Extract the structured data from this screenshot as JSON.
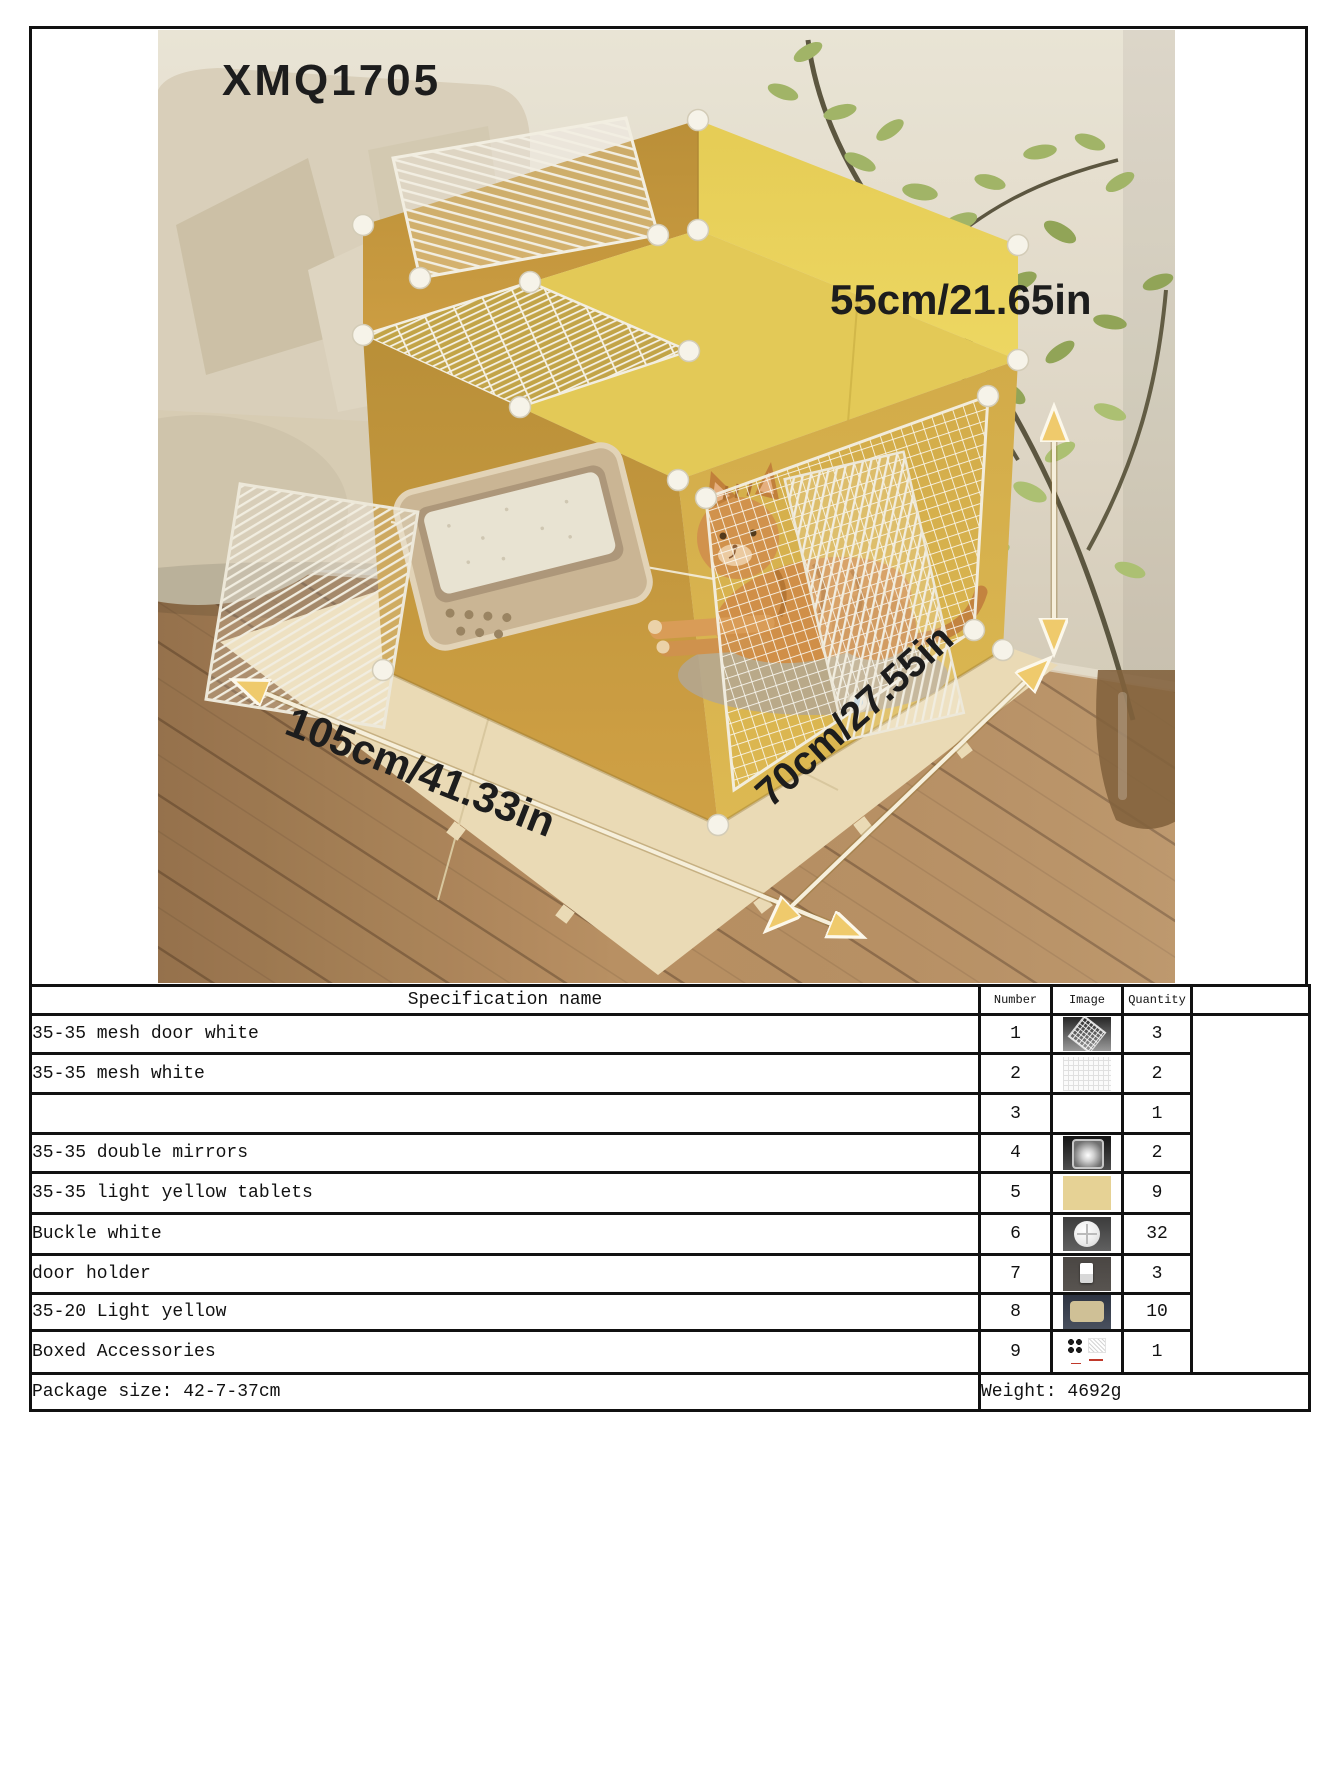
{
  "photo": {
    "model": "XMQ1705",
    "dim_height": "55cm/21.65in",
    "dim_length": "105cm/41.33in",
    "dim_depth": "70cm/27.55in",
    "scene_icons": [
      "cat-icon",
      "cat-cage-icon",
      "litter-box-icon",
      "sofa-icon",
      "plant-icon",
      "wood-floor-icon",
      "puzzle-mat-icon",
      "measurement-arrow-icon"
    ]
  },
  "table": {
    "header": {
      "name": "Specification name",
      "number": "Number",
      "image": "Image",
      "quantity": "Quantity"
    },
    "rows": [
      {
        "name": "35-35 mesh door white",
        "number": "1",
        "image": "mesh-door-thumbnail",
        "quantity": "3"
      },
      {
        "name": "35-35 mesh white",
        "number": "2",
        "image": "mesh-panel-thumbnail",
        "quantity": "2"
      },
      {
        "name": "",
        "number": "3",
        "image": "",
        "quantity": "1"
      },
      {
        "name": "35-35 double mirrors",
        "number": "4",
        "image": "acrylic-panel-thumbnail",
        "quantity": "2"
      },
      {
        "name": "35-35 light yellow tablets",
        "number": "5",
        "image": "yellow-panel-thumbnail",
        "quantity": "9"
      },
      {
        "name": "Buckle white",
        "number": "6",
        "image": "round-buckle-thumbnail",
        "quantity": "32"
      },
      {
        "name": "door holder",
        "number": "7",
        "image": "door-holder-thumbnail",
        "quantity": "3"
      },
      {
        "name": "35-20 Light yellow",
        "number": "8",
        "image": "small-yellow-panel-thumbnail",
        "quantity": "10"
      },
      {
        "name": "Boxed Accessories",
        "number": "9",
        "image": "boxed-accessories-thumbnail",
        "quantity": "1"
      }
    ],
    "footer": {
      "package_size": "Package size: 42-7-37cm",
      "weight": "Weight: 4692g"
    }
  },
  "colors": {
    "cage_yellow_top": "#e3c854",
    "cage_mustard_front": "#c0943a",
    "thumb_yellow": "#e6d295",
    "table_border": "#111111",
    "annotation_text": "#1d1d1d"
  }
}
